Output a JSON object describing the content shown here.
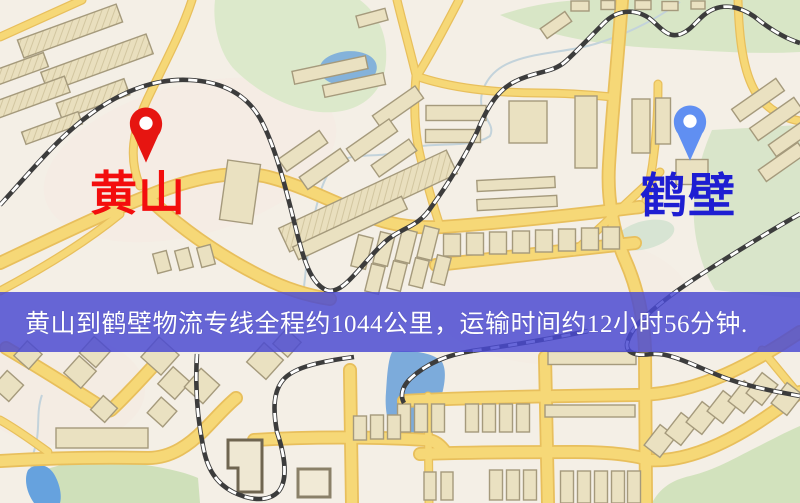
{
  "map": {
    "markers": [
      {
        "name": "origin",
        "label": "黄山",
        "pin_color": "#e61511",
        "label_color": "#f30d0d"
      },
      {
        "name": "destination",
        "label": "鹤壁",
        "pin_color": "#608ff2",
        "label_color": "#1e1ed2"
      }
    ],
    "banner": {
      "text": "黄山到鹤壁物流专线全程约1044公里，运输时间约12小时56分钟.",
      "background_color": "rgba(74,74,210,0.84)",
      "text_color": "#ffffff"
    },
    "palette": {
      "map_background": "#f4efe6",
      "road_fill": "#f6d877",
      "road_casing": "#e8bf5c",
      "railway": "#3c3c3c",
      "park_green": "#d8e6c6",
      "water_blue": "#7cabdb",
      "building_fill": "#eae1c1",
      "building_stroke": "#a59a7c"
    }
  }
}
